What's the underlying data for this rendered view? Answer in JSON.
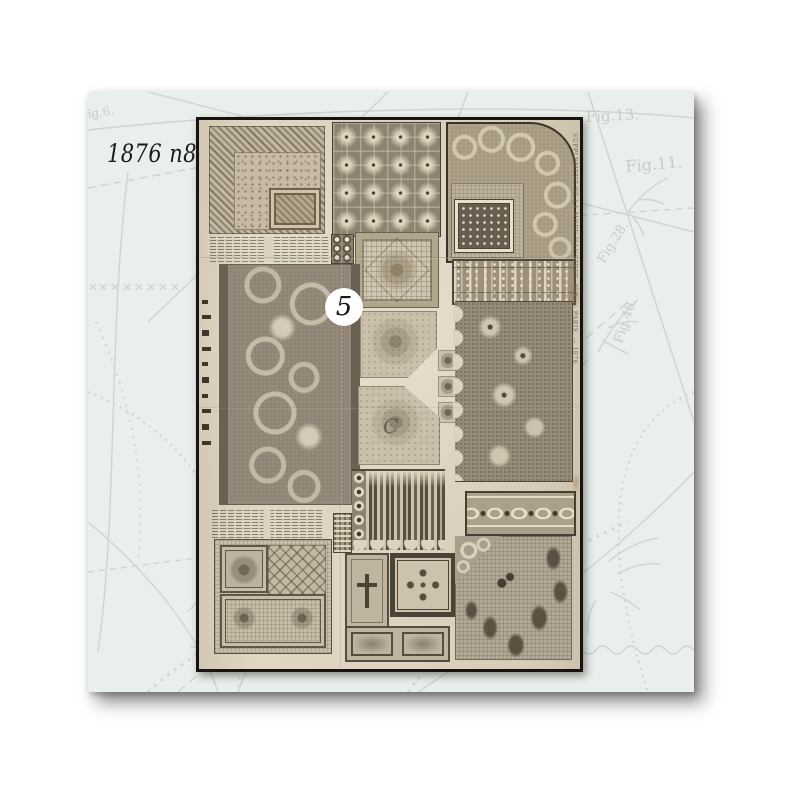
{
  "page": {
    "background_color": "#ffffff"
  },
  "photo": {
    "caption": "1876 n8",
    "badge_number": "5",
    "card_background_color": "#e9efec",
    "pattern_line_color": "#ccd3d1",
    "figure_labels": [
      "Fig.13.",
      "Fig.11.",
      "Fig.28.",
      "Fig.48.",
      "Fig.6."
    ],
    "sheet": {
      "paper_color": "#ddd2bf",
      "border_color": "#17130e",
      "ink_color": "#564d3e",
      "edge_text": "SUPPLEMENT DE LA MODE ILLUSTREE. N 8. — PARIS. — 1876.",
      "monogram": "C",
      "swatches": [
        "cross-stitch-corner-sampler",
        "star-tile-square",
        "lace-border-corner",
        "dotted-square-sampler",
        "lace-band",
        "instruction-text-upper",
        "circle-motif-strip",
        "mosaic-palmette-square",
        "acanthus-scroll-panel",
        "monogram-square-upper",
        "monogram-letters-strip",
        "monogram-square-lower",
        "scalloped-lace-flounce",
        "pointed-lace-edging",
        "interlaced-border-band",
        "instruction-text-lower",
        "mini-sampler-strip",
        "greek-key-square",
        "cross-frame-corner",
        "butterfly-embroidery-corner"
      ]
    }
  }
}
